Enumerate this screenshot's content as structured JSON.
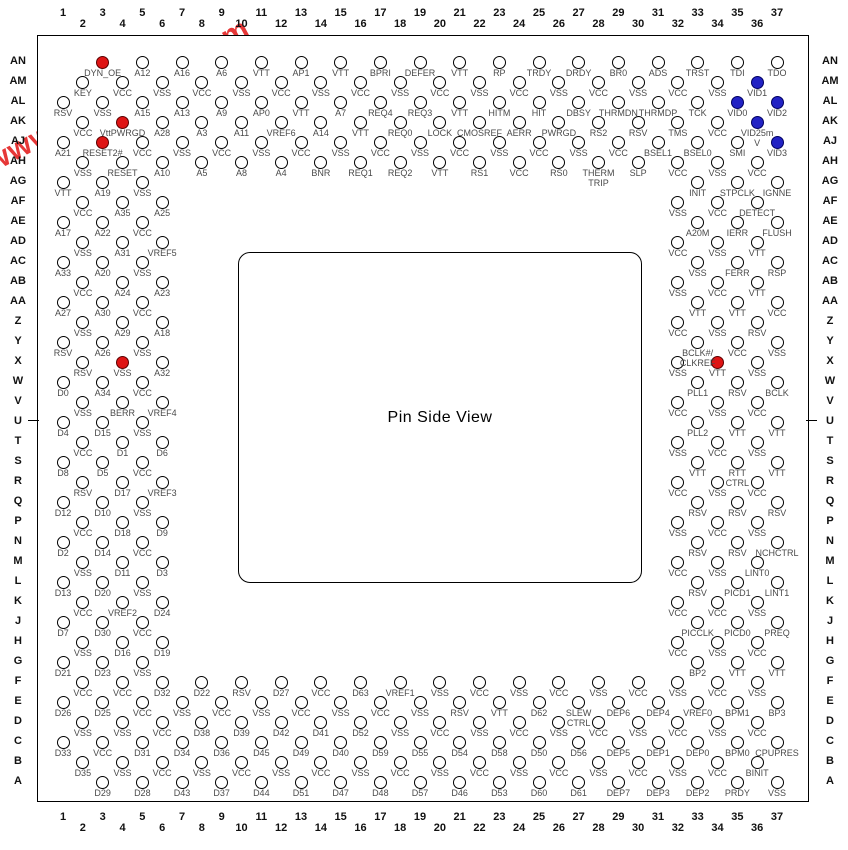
{
  "title": "Pin Side View",
  "watermark": "www.elec-fans.com",
  "colors": {
    "pin_red": "#df1414",
    "pin_blue": "#2222c4",
    "watermark": "#e52c2c"
  },
  "columns_start": 1,
  "columns_end": 37,
  "rows": [
    "AN",
    "AM",
    "AL",
    "AK",
    "AJ",
    "AH",
    "AG",
    "AF",
    "AE",
    "AD",
    "AC",
    "AB",
    "AA",
    "Z",
    "Y",
    "X",
    "W",
    "V",
    "U",
    "T",
    "S",
    "R",
    "Q",
    "P",
    "N",
    "M",
    "L",
    "K",
    "J",
    "H",
    "G",
    "F",
    "E",
    "D",
    "C",
    "B",
    "A"
  ],
  "pins": [
    [
      "AN",
      3,
      "DYN_OE",
      "red"
    ],
    [
      "AN",
      5,
      "A12"
    ],
    [
      "AN",
      7,
      "A16"
    ],
    [
      "AN",
      9,
      "A6"
    ],
    [
      "AN",
      11,
      "VTT"
    ],
    [
      "AN",
      13,
      "AP1"
    ],
    [
      "AN",
      15,
      "VTT"
    ],
    [
      "AN",
      17,
      "BPRI"
    ],
    [
      "AN",
      19,
      "DEFER"
    ],
    [
      "AN",
      21,
      "VTT"
    ],
    [
      "AN",
      23,
      "RP"
    ],
    [
      "AN",
      25,
      "TRDY"
    ],
    [
      "AN",
      27,
      "DRDY"
    ],
    [
      "AN",
      29,
      "BR0"
    ],
    [
      "AN",
      31,
      "ADS"
    ],
    [
      "AN",
      33,
      "TRST"
    ],
    [
      "AN",
      35,
      "TDI"
    ],
    [
      "AN",
      37,
      "TDO"
    ],
    [
      "AM",
      2,
      "KEY"
    ],
    [
      "AM",
      4,
      "VCC"
    ],
    [
      "AM",
      6,
      "VSS"
    ],
    [
      "AM",
      8,
      "VCC"
    ],
    [
      "AM",
      10,
      "VSS"
    ],
    [
      "AM",
      12,
      "VCC"
    ],
    [
      "AM",
      14,
      "VSS"
    ],
    [
      "AM",
      16,
      "VCC"
    ],
    [
      "AM",
      18,
      "VSS"
    ],
    [
      "AM",
      20,
      "VCC"
    ],
    [
      "AM",
      22,
      "VSS"
    ],
    [
      "AM",
      24,
      "VCC"
    ],
    [
      "AM",
      26,
      "VSS"
    ],
    [
      "AM",
      28,
      "VCC"
    ],
    [
      "AM",
      30,
      "VSS"
    ],
    [
      "AM",
      32,
      "VCC"
    ],
    [
      "AM",
      34,
      "VSS"
    ],
    [
      "AM",
      36,
      "VID1",
      "blue"
    ],
    [
      "AL",
      1,
      "RSV"
    ],
    [
      "AL",
      3,
      "VSS"
    ],
    [
      "AL",
      5,
      "A15"
    ],
    [
      "AL",
      7,
      "A13"
    ],
    [
      "AL",
      9,
      "A9"
    ],
    [
      "AL",
      11,
      "AP0"
    ],
    [
      "AL",
      13,
      "VTT"
    ],
    [
      "AL",
      15,
      "A7"
    ],
    [
      "AL",
      17,
      "REQ4"
    ],
    [
      "AL",
      19,
      "REQ3"
    ],
    [
      "AL",
      21,
      "VTT"
    ],
    [
      "AL",
      23,
      "HITM"
    ],
    [
      "AL",
      25,
      "HIT"
    ],
    [
      "AL",
      27,
      "DBSY"
    ],
    [
      "AL",
      29,
      "THRMDN"
    ],
    [
      "AL",
      31,
      "THRMDP"
    ],
    [
      "AL",
      33,
      "TCK"
    ],
    [
      "AL",
      35,
      "VID0",
      "blue"
    ],
    [
      "AL",
      37,
      "VID2",
      "blue"
    ],
    [
      "AK",
      2,
      "VCC"
    ],
    [
      "AK",
      4,
      "VttPWRGD",
      "red"
    ],
    [
      "AK",
      6,
      "A28"
    ],
    [
      "AK",
      8,
      "A3"
    ],
    [
      "AK",
      10,
      "A11"
    ],
    [
      "AK",
      12,
      "VREF6"
    ],
    [
      "AK",
      14,
      "A14"
    ],
    [
      "AK",
      16,
      "VTT"
    ],
    [
      "AK",
      18,
      "REQ0"
    ],
    [
      "AK",
      20,
      "LOCK"
    ],
    [
      "AK",
      22,
      "CMOSREF"
    ],
    [
      "AK",
      24,
      "AERR"
    ],
    [
      "AK",
      26,
      "PWRGD"
    ],
    [
      "AK",
      28,
      "RS2"
    ],
    [
      "AK",
      30,
      "RSV"
    ],
    [
      "AK",
      32,
      "TMS"
    ],
    [
      "AK",
      34,
      "VCC"
    ],
    [
      "AK",
      36,
      "VID25m\nV",
      "blue"
    ],
    [
      "AJ",
      1,
      "A21"
    ],
    [
      "AJ",
      3,
      "RESET2#",
      "red"
    ],
    [
      "AJ",
      5,
      "VCC"
    ],
    [
      "AJ",
      7,
      "VSS"
    ],
    [
      "AJ",
      9,
      "VCC"
    ],
    [
      "AJ",
      11,
      "VSS"
    ],
    [
      "AJ",
      13,
      "VCC"
    ],
    [
      "AJ",
      15,
      "VSS"
    ],
    [
      "AJ",
      17,
      "VCC"
    ],
    [
      "AJ",
      19,
      "VSS"
    ],
    [
      "AJ",
      21,
      "VCC"
    ],
    [
      "AJ",
      23,
      "VSS"
    ],
    [
      "AJ",
      25,
      "VCC"
    ],
    [
      "AJ",
      27,
      "VSS"
    ],
    [
      "AJ",
      29,
      "VCC"
    ],
    [
      "AJ",
      31,
      "BSEL1"
    ],
    [
      "AJ",
      33,
      "BSEL0"
    ],
    [
      "AJ",
      35,
      "SMI"
    ],
    [
      "AJ",
      37,
      "VID3",
      "blue"
    ],
    [
      "AH",
      2,
      "VSS"
    ],
    [
      "AH",
      4,
      "RESET"
    ],
    [
      "AH",
      6,
      "A10"
    ],
    [
      "AH",
      8,
      "A5"
    ],
    [
      "AH",
      10,
      "A8"
    ],
    [
      "AH",
      12,
      "A4"
    ],
    [
      "AH",
      14,
      "BNR"
    ],
    [
      "AH",
      16,
      "REQ1"
    ],
    [
      "AH",
      18,
      "REQ2"
    ],
    [
      "AH",
      20,
      "VTT"
    ],
    [
      "AH",
      22,
      "RS1"
    ],
    [
      "AH",
      24,
      "VCC"
    ],
    [
      "AH",
      26,
      "RS0"
    ],
    [
      "AH",
      28,
      "THERM\nTRIP"
    ],
    [
      "AH",
      30,
      "SLP"
    ],
    [
      "AH",
      32,
      "VCC"
    ],
    [
      "AH",
      34,
      "VSS"
    ],
    [
      "AH",
      36,
      "VCC"
    ],
    [
      "AG",
      1,
      "VTT"
    ],
    [
      "AG",
      3,
      "A19"
    ],
    [
      "AG",
      5,
      "VSS"
    ],
    [
      "AG",
      33,
      "INIT"
    ],
    [
      "AG",
      35,
      "STPCLK"
    ],
    [
      "AG",
      37,
      "IGNNE"
    ],
    [
      "AF",
      2,
      "VCC"
    ],
    [
      "AF",
      4,
      "A35"
    ],
    [
      "AF",
      6,
      "A25"
    ],
    [
      "AF",
      32,
      "VSS"
    ],
    [
      "AF",
      34,
      "VCC"
    ],
    [
      "AF",
      36,
      "DETECT"
    ],
    [
      "AE",
      1,
      "A17"
    ],
    [
      "AE",
      3,
      "A22"
    ],
    [
      "AE",
      5,
      "VCC"
    ],
    [
      "AE",
      33,
      "A20M"
    ],
    [
      "AE",
      35,
      "IERR"
    ],
    [
      "AE",
      37,
      "FLUSH"
    ],
    [
      "AD",
      2,
      "VSS"
    ],
    [
      "AD",
      4,
      "A31"
    ],
    [
      "AD",
      6,
      "VREF5"
    ],
    [
      "AD",
      32,
      "VCC"
    ],
    [
      "AD",
      34,
      "VSS"
    ],
    [
      "AD",
      36,
      "VTT"
    ],
    [
      "AC",
      1,
      "A33"
    ],
    [
      "AC",
      3,
      "A20"
    ],
    [
      "AC",
      5,
      "VSS"
    ],
    [
      "AC",
      33,
      "VSS"
    ],
    [
      "AC",
      35,
      "FERR"
    ],
    [
      "AC",
      37,
      "RSP"
    ],
    [
      "AB",
      2,
      "VCC"
    ],
    [
      "AB",
      4,
      "A24"
    ],
    [
      "AB",
      6,
      "A23"
    ],
    [
      "AB",
      32,
      "VSS"
    ],
    [
      "AB",
      34,
      "VCC"
    ],
    [
      "AB",
      36,
      "VTT"
    ],
    [
      "AA",
      1,
      "A27"
    ],
    [
      "AA",
      3,
      "A30"
    ],
    [
      "AA",
      5,
      "VCC"
    ],
    [
      "AA",
      33,
      "VTT"
    ],
    [
      "AA",
      35,
      "VTT"
    ],
    [
      "AA",
      37,
      "VCC"
    ],
    [
      "Z",
      2,
      "VSS"
    ],
    [
      "Z",
      4,
      "A29"
    ],
    [
      "Z",
      6,
      "A18"
    ],
    [
      "Z",
      32,
      "VCC"
    ],
    [
      "Z",
      34,
      "VSS"
    ],
    [
      "Z",
      36,
      "RSV"
    ],
    [
      "Y",
      1,
      "RSV"
    ],
    [
      "Y",
      3,
      "A26"
    ],
    [
      "Y",
      5,
      "VSS"
    ],
    [
      "Y",
      33,
      "BCLK#/\nCLKREF"
    ],
    [
      "Y",
      35,
      "VCC"
    ],
    [
      "Y",
      37,
      "VSS"
    ],
    [
      "X",
      2,
      "RSV"
    ],
    [
      "X",
      4,
      "VSS",
      "red"
    ],
    [
      "X",
      6,
      "A32"
    ],
    [
      "X",
      32,
      "VSS"
    ],
    [
      "X",
      34,
      "VTT",
      "red"
    ],
    [
      "X",
      36,
      "VSS"
    ],
    [
      "W",
      1,
      "D0"
    ],
    [
      "W",
      3,
      "A34"
    ],
    [
      "W",
      5,
      "VCC"
    ],
    [
      "W",
      33,
      "PLL1"
    ],
    [
      "W",
      35,
      "RSV"
    ],
    [
      "W",
      37,
      "BCLK"
    ],
    [
      "V",
      2,
      "VSS"
    ],
    [
      "V",
      4,
      "BERR"
    ],
    [
      "V",
      6,
      "VREF4"
    ],
    [
      "V",
      32,
      "VCC"
    ],
    [
      "V",
      34,
      "VSS"
    ],
    [
      "V",
      36,
      "VCC"
    ],
    [
      "U",
      1,
      "D4"
    ],
    [
      "U",
      3,
      "D15"
    ],
    [
      "U",
      5,
      "VSS"
    ],
    [
      "U",
      33,
      "PLL2"
    ],
    [
      "U",
      35,
      "VTT"
    ],
    [
      "U",
      37,
      "VTT"
    ],
    [
      "T",
      2,
      "VCC"
    ],
    [
      "T",
      4,
      "D1"
    ],
    [
      "T",
      6,
      "D6"
    ],
    [
      "T",
      32,
      "VSS"
    ],
    [
      "T",
      34,
      "VCC"
    ],
    [
      "T",
      36,
      "VSS"
    ],
    [
      "S",
      1,
      "D8"
    ],
    [
      "S",
      3,
      "D5"
    ],
    [
      "S",
      5,
      "VCC"
    ],
    [
      "S",
      33,
      "VTT"
    ],
    [
      "S",
      35,
      "RTT\nCTRL"
    ],
    [
      "S",
      37,
      "VTT"
    ],
    [
      "R",
      2,
      "RSV"
    ],
    [
      "R",
      4,
      "D17"
    ],
    [
      "R",
      6,
      "VREF3"
    ],
    [
      "R",
      32,
      "VCC"
    ],
    [
      "R",
      34,
      "VSS"
    ],
    [
      "R",
      36,
      "VCC"
    ],
    [
      "Q",
      1,
      "D12"
    ],
    [
      "Q",
      3,
      "D10"
    ],
    [
      "Q",
      5,
      "VSS"
    ],
    [
      "Q",
      33,
      "RSV"
    ],
    [
      "Q",
      35,
      "RSV"
    ],
    [
      "Q",
      37,
      "RSV"
    ],
    [
      "P",
      2,
      "VCC"
    ],
    [
      "P",
      4,
      "D18"
    ],
    [
      "P",
      6,
      "D9"
    ],
    [
      "P",
      32,
      "VSS"
    ],
    [
      "P",
      34,
      "VCC"
    ],
    [
      "P",
      36,
      "VSS"
    ],
    [
      "N",
      1,
      "D2"
    ],
    [
      "N",
      3,
      "D14"
    ],
    [
      "N",
      5,
      "VCC"
    ],
    [
      "N",
      33,
      "RSV"
    ],
    [
      "N",
      35,
      "RSV"
    ],
    [
      "N",
      37,
      "NCHCTRL"
    ],
    [
      "M",
      2,
      "VSS"
    ],
    [
      "M",
      4,
      "D11"
    ],
    [
      "M",
      6,
      "D3"
    ],
    [
      "M",
      32,
      "VCC"
    ],
    [
      "M",
      34,
      "VSS"
    ],
    [
      "M",
      36,
      "LINT0"
    ],
    [
      "L",
      1,
      "D13"
    ],
    [
      "L",
      3,
      "D20"
    ],
    [
      "L",
      5,
      "VSS"
    ],
    [
      "L",
      33,
      "RSV"
    ],
    [
      "L",
      35,
      "PICD1"
    ],
    [
      "L",
      37,
      "LINT1"
    ],
    [
      "K",
      2,
      "VCC"
    ],
    [
      "K",
      4,
      "VREF2"
    ],
    [
      "K",
      6,
      "D24"
    ],
    [
      "K",
      32,
      "VCC"
    ],
    [
      "K",
      34,
      "VCC"
    ],
    [
      "K",
      36,
      "VSS"
    ],
    [
      "J",
      1,
      "D7"
    ],
    [
      "J",
      3,
      "D30"
    ],
    [
      "J",
      5,
      "VCC"
    ],
    [
      "J",
      33,
      "PICCLK"
    ],
    [
      "J",
      35,
      "PICD0"
    ],
    [
      "J",
      37,
      "PREQ"
    ],
    [
      "H",
      2,
      "VSS"
    ],
    [
      "H",
      4,
      "D16"
    ],
    [
      "H",
      6,
      "D19"
    ],
    [
      "H",
      32,
      "VCC"
    ],
    [
      "H",
      34,
      "VSS"
    ],
    [
      "H",
      36,
      "VCC"
    ],
    [
      "G",
      1,
      "D21"
    ],
    [
      "G",
      3,
      "D23"
    ],
    [
      "G",
      5,
      "VSS"
    ],
    [
      "G",
      33,
      "BP2"
    ],
    [
      "G",
      35,
      "VTT"
    ],
    [
      "G",
      37,
      "VTT"
    ],
    [
      "F",
      2,
      "VCC"
    ],
    [
      "F",
      4,
      "VCC"
    ],
    [
      "F",
      6,
      "D32"
    ],
    [
      "F",
      8,
      "D22"
    ],
    [
      "F",
      10,
      "RSV"
    ],
    [
      "F",
      12,
      "D27"
    ],
    [
      "F",
      14,
      "VCC"
    ],
    [
      "F",
      16,
      "D63"
    ],
    [
      "F",
      18,
      "VREF1"
    ],
    [
      "F",
      20,
      "VSS"
    ],
    [
      "F",
      22,
      "VCC"
    ],
    [
      "F",
      24,
      "VSS"
    ],
    [
      "F",
      26,
      "VCC"
    ],
    [
      "F",
      28,
      "VSS"
    ],
    [
      "F",
      30,
      "VCC"
    ],
    [
      "F",
      32,
      "VSS"
    ],
    [
      "F",
      34,
      "VCC"
    ],
    [
      "F",
      36,
      "VSS"
    ],
    [
      "E",
      1,
      "D26"
    ],
    [
      "E",
      3,
      "D25"
    ],
    [
      "E",
      5,
      "VCC"
    ],
    [
      "E",
      7,
      "VSS"
    ],
    [
      "E",
      9,
      "VCC"
    ],
    [
      "E",
      11,
      "VSS"
    ],
    [
      "E",
      13,
      "VCC"
    ],
    [
      "E",
      15,
      "VSS"
    ],
    [
      "E",
      17,
      "VCC"
    ],
    [
      "E",
      19,
      "VSS"
    ],
    [
      "E",
      21,
      "RSV"
    ],
    [
      "E",
      23,
      "VTT"
    ],
    [
      "E",
      25,
      "D62"
    ],
    [
      "E",
      27,
      "SLEW\nCTRL"
    ],
    [
      "E",
      29,
      "DEP6"
    ],
    [
      "E",
      31,
      "DEP4"
    ],
    [
      "E",
      33,
      "VREF0"
    ],
    [
      "E",
      35,
      "BPM1"
    ],
    [
      "E",
      37,
      "BP3"
    ],
    [
      "D",
      2,
      "VSS"
    ],
    [
      "D",
      4,
      "VSS"
    ],
    [
      "D",
      6,
      "VCC"
    ],
    [
      "D",
      8,
      "D38"
    ],
    [
      "D",
      10,
      "D39"
    ],
    [
      "D",
      12,
      "D42"
    ],
    [
      "D",
      14,
      "D41"
    ],
    [
      "D",
      16,
      "D52"
    ],
    [
      "D",
      18,
      "VSS"
    ],
    [
      "D",
      20,
      "VCC"
    ],
    [
      "D",
      22,
      "VSS"
    ],
    [
      "D",
      24,
      "VCC"
    ],
    [
      "D",
      26,
      "VSS"
    ],
    [
      "D",
      28,
      "VCC"
    ],
    [
      "D",
      30,
      "VSS"
    ],
    [
      "D",
      32,
      "VCC"
    ],
    [
      "D",
      34,
      "VSS"
    ],
    [
      "D",
      36,
      "VCC"
    ],
    [
      "C",
      1,
      "D33"
    ],
    [
      "C",
      3,
      "VCC"
    ],
    [
      "C",
      5,
      "D31"
    ],
    [
      "C",
      7,
      "D34"
    ],
    [
      "C",
      9,
      "D36"
    ],
    [
      "C",
      11,
      "D45"
    ],
    [
      "C",
      13,
      "D49"
    ],
    [
      "C",
      15,
      "D40"
    ],
    [
      "C",
      17,
      "D59"
    ],
    [
      "C",
      19,
      "D55"
    ],
    [
      "C",
      21,
      "D54"
    ],
    [
      "C",
      23,
      "D58"
    ],
    [
      "C",
      25,
      "D50"
    ],
    [
      "C",
      27,
      "D56"
    ],
    [
      "C",
      29,
      "DEP5"
    ],
    [
      "C",
      31,
      "DEP1"
    ],
    [
      "C",
      33,
      "DEP0"
    ],
    [
      "C",
      35,
      "BPM0"
    ],
    [
      "C",
      37,
      "CPUPRES"
    ],
    [
      "B",
      2,
      "D35"
    ],
    [
      "B",
      4,
      "VSS"
    ],
    [
      "B",
      6,
      "VCC"
    ],
    [
      "B",
      8,
      "VSS"
    ],
    [
      "B",
      10,
      "VCC"
    ],
    [
      "B",
      12,
      "VSS"
    ],
    [
      "B",
      14,
      "VCC"
    ],
    [
      "B",
      16,
      "VSS"
    ],
    [
      "B",
      18,
      "VCC"
    ],
    [
      "B",
      20,
      "VSS"
    ],
    [
      "B",
      22,
      "VCC"
    ],
    [
      "B",
      24,
      "VSS"
    ],
    [
      "B",
      26,
      "VCC"
    ],
    [
      "B",
      28,
      "VSS"
    ],
    [
      "B",
      30,
      "VCC"
    ],
    [
      "B",
      32,
      "VSS"
    ],
    [
      "B",
      34,
      "VCC"
    ],
    [
      "B",
      36,
      "BINIT"
    ],
    [
      "A",
      3,
      "D29"
    ],
    [
      "A",
      5,
      "D28"
    ],
    [
      "A",
      7,
      "D43"
    ],
    [
      "A",
      9,
      "D37"
    ],
    [
      "A",
      11,
      "D44"
    ],
    [
      "A",
      13,
      "D51"
    ],
    [
      "A",
      15,
      "D47"
    ],
    [
      "A",
      17,
      "D48"
    ],
    [
      "A",
      19,
      "D57"
    ],
    [
      "A",
      21,
      "D46"
    ],
    [
      "A",
      23,
      "D53"
    ],
    [
      "A",
      25,
      "D60"
    ],
    [
      "A",
      27,
      "D61"
    ],
    [
      "A",
      29,
      "DEP7"
    ],
    [
      "A",
      31,
      "DEP3"
    ],
    [
      "A",
      33,
      "DEP2"
    ],
    [
      "A",
      35,
      "PRDY"
    ],
    [
      "A",
      37,
      "VSS"
    ]
  ]
}
